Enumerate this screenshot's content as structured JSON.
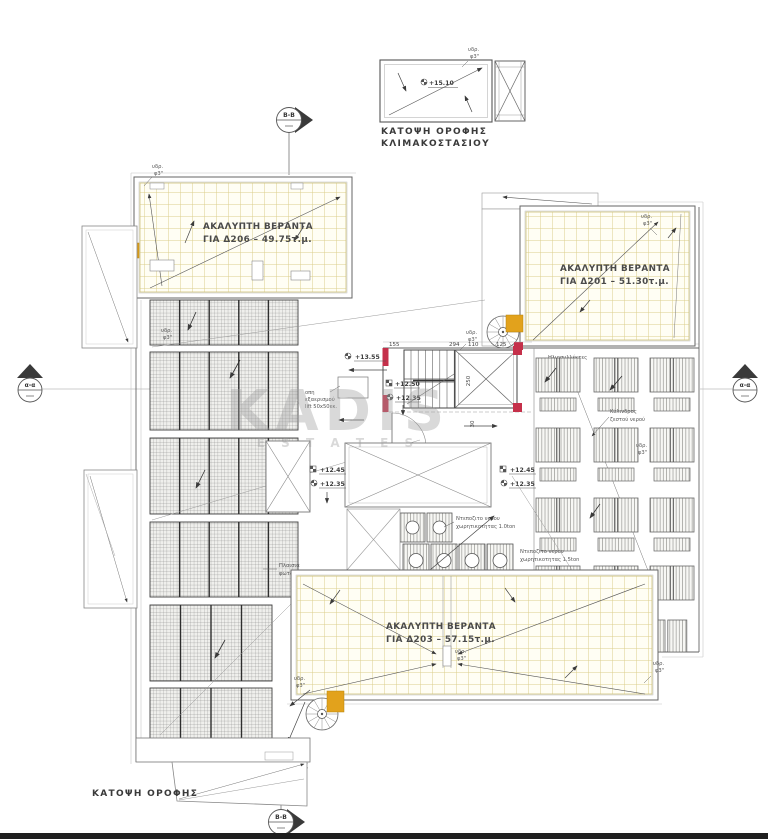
{
  "page": {
    "background": "#ffffff",
    "footer_bar_color": "#1f1f1f"
  },
  "colors": {
    "accent_orange": "#e2a21c",
    "wall_red": "#c5304a",
    "veranda_grid": "#dbce8b",
    "line_dark": "#555555"
  },
  "stairwell_plan": {
    "title_line1": "ΚΑΤΟΨΗ ΟΡΟΦΗΣ",
    "title_line2": "ΚΛΙΜΑΚΟΣΤΑΣΙΟΥ",
    "elevation": "+15.10"
  },
  "section_markers": {
    "vertical": "Β-Β",
    "horizontal": "α-α"
  },
  "verandas": {
    "d206": {
      "line1": "ΑΚΑΛΥΠΤΗ ΒΕΡΑΝΤΑ",
      "line2": "ΓΙΑ Δ206 – 49.75τ.μ."
    },
    "d201": {
      "line1": "ΑΚΑΛΥΠΤΗ ΒΕΡΑΝΤΑ",
      "line2": "ΓΙΑ Δ201 – 51.30τ.μ."
    },
    "d203": {
      "line1": "ΑΚΑΛΥΠΤΗ ΒΕΡΑΝΤΑ",
      "line2": "ΓΙΑ Δ203 – 57.15τ.μ."
    }
  },
  "equipment": {
    "pv_line1": "Πλαισια",
    "pv_line2": "φωτοβολταικων",
    "collectors": "Ηλιοσυλλέκτες",
    "cylinder_line1": "Κύλινδρος",
    "cylinder_line2": "ζεστού νερού",
    "tank_1_0_line1": "Ντεποζιτο νερου",
    "tank_1_0_line2": "χωρητικοτητας 1.0ton",
    "tank_1_5_line1": "Ντεποζιτο νερου",
    "tank_1_5_line2": "χωρητικοτητας 1.5ton",
    "vent_line1": "οπη",
    "vent_line2": "εξαερισμού",
    "vent_line3": "lift 50x50εκ."
  },
  "drain_label": {
    "line1": "υδρ.",
    "line2": "φ3\""
  },
  "elevations": {
    "stair_top": "+13.55",
    "landing_upper": "+12.50",
    "landing_lower": "+12.35",
    "roof_upper": "+12.45",
    "roof_lower": "+12.35"
  },
  "dimensions": {
    "d1": "155",
    "d2": "294",
    "d3": "110",
    "d4": "125",
    "d5": "250",
    "d6": "30"
  },
  "main_title": "ΚΑΤΟΨΗ ΟΡΟΦΗΣ",
  "watermark": {
    "name": "KADIS",
    "subtitle": "E S T A T E S"
  }
}
